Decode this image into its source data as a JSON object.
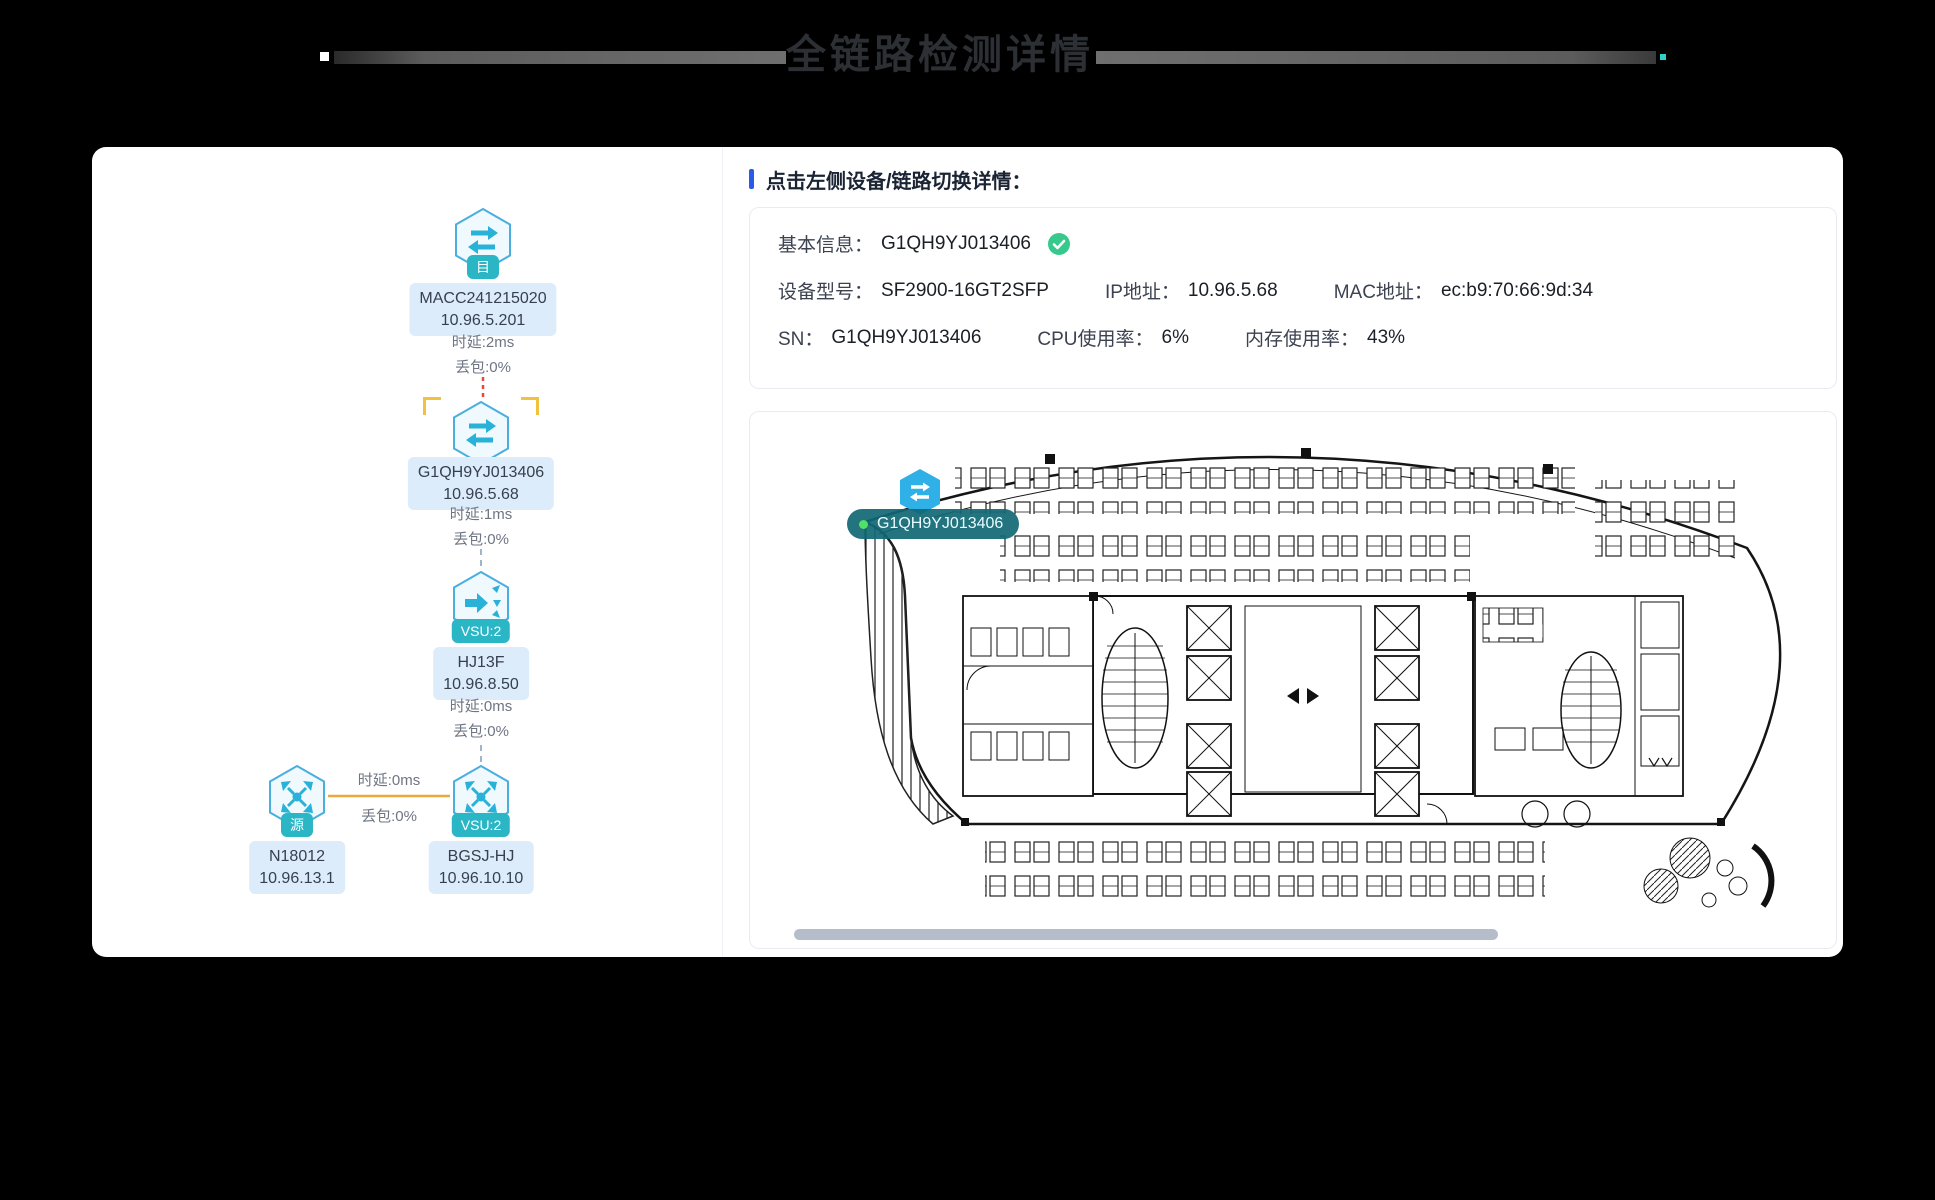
{
  "page": {
    "title": "全链路检测详情"
  },
  "colors": {
    "accent_blue": "#2a5ae8",
    "node_badge_teal": "#2bb6c6",
    "node_label_bg": "#dcecfb",
    "link_red": "#e14b3a",
    "link_dashed_blue": "#9fb6c8",
    "link_orange": "#e8aa3c",
    "selection_yellow": "#f2c23e",
    "status_green": "#35ca8c",
    "marker_blue": "#2fb0e6",
    "marker_pill_teal": "#106874"
  },
  "topology": {
    "nodes": [
      {
        "name": "MACC241215020",
        "ip": "10.96.5.201",
        "badge": "目",
        "icon": "switch-icon",
        "latency": "时延:2ms",
        "loss": "丢包:0%"
      },
      {
        "name": "G1QH9YJ013406",
        "ip": "10.96.5.68",
        "badge": "",
        "icon": "switch-icon",
        "latency": "时延:1ms",
        "loss": "丢包:0%"
      },
      {
        "name": "HJ13F",
        "ip": "10.96.8.50",
        "badge": "VSU:2",
        "icon": "uplink-icon",
        "latency": "时延:0ms",
        "loss": "丢包:0%"
      },
      {
        "name": "BGSJ-HJ",
        "ip": "10.96.10.10",
        "badge": "VSU:2",
        "icon": "router-icon"
      },
      {
        "name": "N18012",
        "ip": "10.96.13.1",
        "badge": "源",
        "icon": "router-icon"
      }
    ],
    "bottom_link": {
      "latency": "时延:0ms",
      "loss": "丢包:0%"
    }
  },
  "detail": {
    "header": "点击左侧设备/链路切换详情：",
    "info": {
      "basic_label": "基本信息：",
      "basic_value": "G1QH9YJ013406",
      "rows": [
        [
          {
            "label": "设备型号：",
            "value": "SF2900-16GT2SFP"
          },
          {
            "label": "IP地址：",
            "value": "10.96.5.68"
          },
          {
            "label": "MAC地址：",
            "value": "ec:b9:70:66:9d:34"
          }
        ],
        [
          {
            "label": "SN：",
            "value": "G1QH9YJ013406"
          },
          {
            "label": "CPU使用率：",
            "value": "6%"
          },
          {
            "label": "内存使用率：",
            "value": "43%"
          }
        ]
      ]
    },
    "floorplan": {
      "marker_label": "G1QH9YJ013406"
    }
  }
}
